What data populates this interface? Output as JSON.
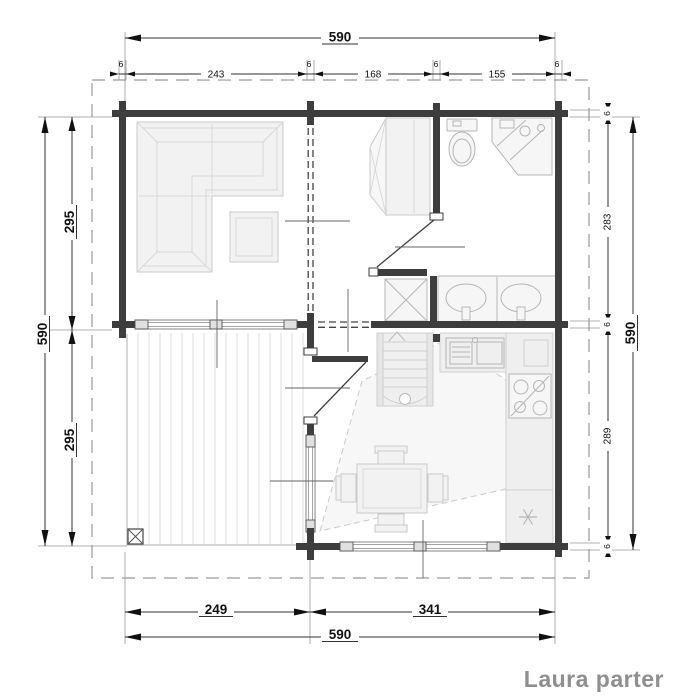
{
  "title": "Laura parter",
  "colors": {
    "wall": "#3d3d3d",
    "furniture_fill": "#f2f2f2",
    "furniture_stroke": "#c9c9c9",
    "title_gray": "#8f8f8f",
    "dimension_text": "#111111"
  },
  "dimensions": {
    "top": {
      "total": "590",
      "segments": [
        "6",
        "243",
        "6",
        "168",
        "6",
        "155",
        "6"
      ]
    },
    "left": {
      "total": "590",
      "segments": [
        "295",
        "295"
      ]
    },
    "right": {
      "total": "590",
      "segments": [
        "6",
        "283",
        "6",
        "289",
        "6"
      ]
    },
    "bottom": {
      "total": "590",
      "segments": [
        "249",
        "341"
      ]
    }
  },
  "symbols": [
    "corner-sofa",
    "coffee-table",
    "wardrobe",
    "toilet",
    "corner-shower",
    "double-washbasin",
    "shower-tray",
    "staircase",
    "kitchen-sink",
    "stove",
    "refrigerator-snowflake",
    "dining-table",
    "dining-chair",
    "terrace-post",
    "deck-boards",
    "window",
    "door-leaf",
    "log-wall"
  ]
}
